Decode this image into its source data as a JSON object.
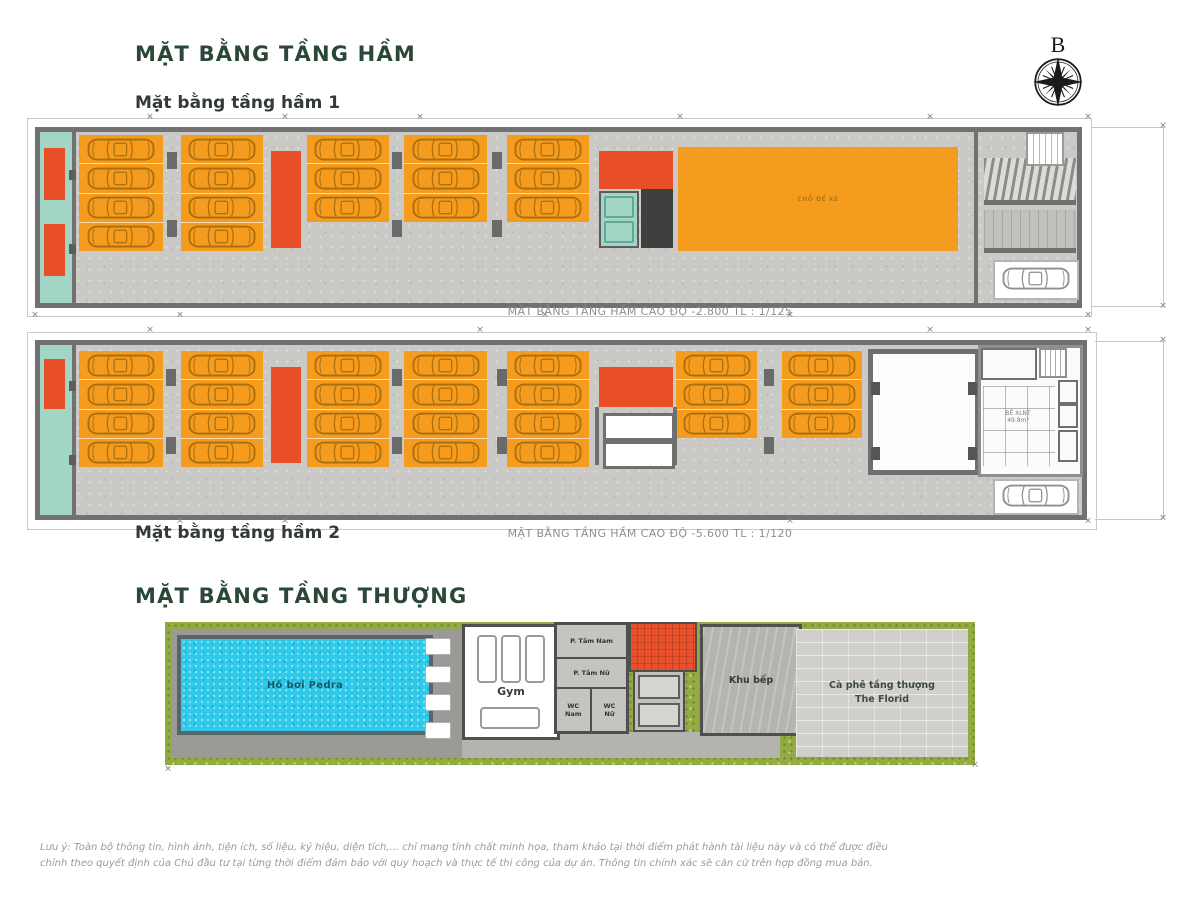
{
  "header": {
    "title": "MẶT BẰNG TẦNG HẦM",
    "compass_label": "B"
  },
  "basement1": {
    "subtitle": "Mặt bằng tầng hầm 1",
    "caption": "MẶT BẰNG TẦNG HẦM CAO ĐỘ -2.800 TL : 1/125",
    "moto_area_label": "CHỖ ĐỂ XE",
    "blocks": [
      {
        "x": 39,
        "y": 3,
        "w": 84,
        "cars": 4
      },
      {
        "x": 141,
        "y": 3,
        "w": 82,
        "cars": 4
      },
      {
        "x": 267,
        "y": 3,
        "w": 82,
        "cars": 3
      },
      {
        "x": 364,
        "y": 3,
        "w": 83,
        "cars": 3
      },
      {
        "x": 467,
        "y": 3,
        "w": 82,
        "cars": 3
      }
    ],
    "columns": [
      [
        127,
        20
      ],
      [
        127,
        88
      ],
      [
        352,
        20
      ],
      [
        352,
        88
      ],
      [
        452,
        20
      ],
      [
        452,
        88
      ],
      [
        700,
        15
      ],
      [
        795,
        15
      ],
      [
        700,
        101
      ],
      [
        795,
        101
      ]
    ]
  },
  "basement2": {
    "subtitle": "Mặt bằng tầng hầm 2",
    "caption": "MẶT BẰNG TẦNG HẦM CAO ĐỘ -5.600 TL : 1/120",
    "tank_label": "BỂ XLNT\n49.8m³",
    "blocks": [
      {
        "x": 39,
        "y": 6,
        "w": 84,
        "cars": 4
      },
      {
        "x": 141,
        "y": 6,
        "w": 82,
        "cars": 4
      },
      {
        "x": 267,
        "y": 6,
        "w": 82,
        "cars": 4
      },
      {
        "x": 364,
        "y": 6,
        "w": 83,
        "cars": 4
      },
      {
        "x": 467,
        "y": 6,
        "w": 82,
        "cars": 4
      },
      {
        "x": 636,
        "y": 6,
        "w": 81,
        "cars": 3
      },
      {
        "x": 742,
        "y": 6,
        "w": 80,
        "cars": 3
      }
    ],
    "columns": [
      [
        126,
        24
      ],
      [
        126,
        92
      ],
      [
        352,
        24
      ],
      [
        352,
        92
      ],
      [
        457,
        24
      ],
      [
        457,
        92
      ],
      [
        724,
        24
      ],
      [
        724,
        92
      ]
    ]
  },
  "rooftop": {
    "title": "MẶT BẰNG TẦNG THƯỢNG",
    "pool_label": "Hồ bơi Pedra",
    "gym_label": "Gym",
    "shower_men_label": "P. Tắm Nam",
    "shower_women_label": "P. Tắm Nữ",
    "wc_men_label": "WC\nNam",
    "wc_women_label": "WC\nNữ",
    "kitchen_label": "Khu bếp",
    "cafe_label": "Cà phê tầng thượng\nThe Florid",
    "lounge_chairs": 4
  },
  "footer": {
    "disclaimer_line1": "Lưu ý: Toàn bộ thông tin, hình ảnh, tiện ích, số liệu, ký hiệu, diện tích,... chỉ mang tính chất minh họa, tham khảo tại thời điểm phát hành tài liệu này và có thể được điều",
    "disclaimer_line2": "chỉnh theo quyết định của Chủ đầu tư tại từng thời điểm đảm bảo với quy hoạch và thực tế thi công của dự án. Thông tin chính xác sẽ căn cứ trên hợp đồng mua bán."
  },
  "colors": {
    "title_green": "#2A4737",
    "parking_orange": "#F59C1E",
    "car_outline": "#A96E0E",
    "stall_car_outline": "#8f8f8f",
    "ramp_red": "#E94F26",
    "core_teal": "#A2D5C6",
    "pool_cyan": "#2FC9E9",
    "grass_green": "#93AB43"
  },
  "ticks": {
    "basement1": [
      [
        150,
        118
      ],
      [
        285,
        118
      ],
      [
        420,
        118
      ],
      [
        680,
        118
      ],
      [
        930,
        118
      ],
      [
        1088,
        118
      ],
      [
        35,
        316
      ],
      [
        180,
        316
      ],
      [
        545,
        316
      ],
      [
        790,
        316
      ],
      [
        1088,
        316
      ],
      [
        1163,
        127
      ],
      [
        1163,
        307
      ]
    ],
    "basement2": [
      [
        150,
        331
      ],
      [
        480,
        331
      ],
      [
        930,
        331
      ],
      [
        1088,
        331
      ],
      [
        180,
        522
      ],
      [
        285,
        522
      ],
      [
        790,
        522
      ],
      [
        1088,
        522
      ],
      [
        1163,
        341
      ],
      [
        1163,
        519
      ]
    ],
    "rooftop": [
      [
        168,
        770
      ],
      [
        975,
        766
      ]
    ]
  }
}
